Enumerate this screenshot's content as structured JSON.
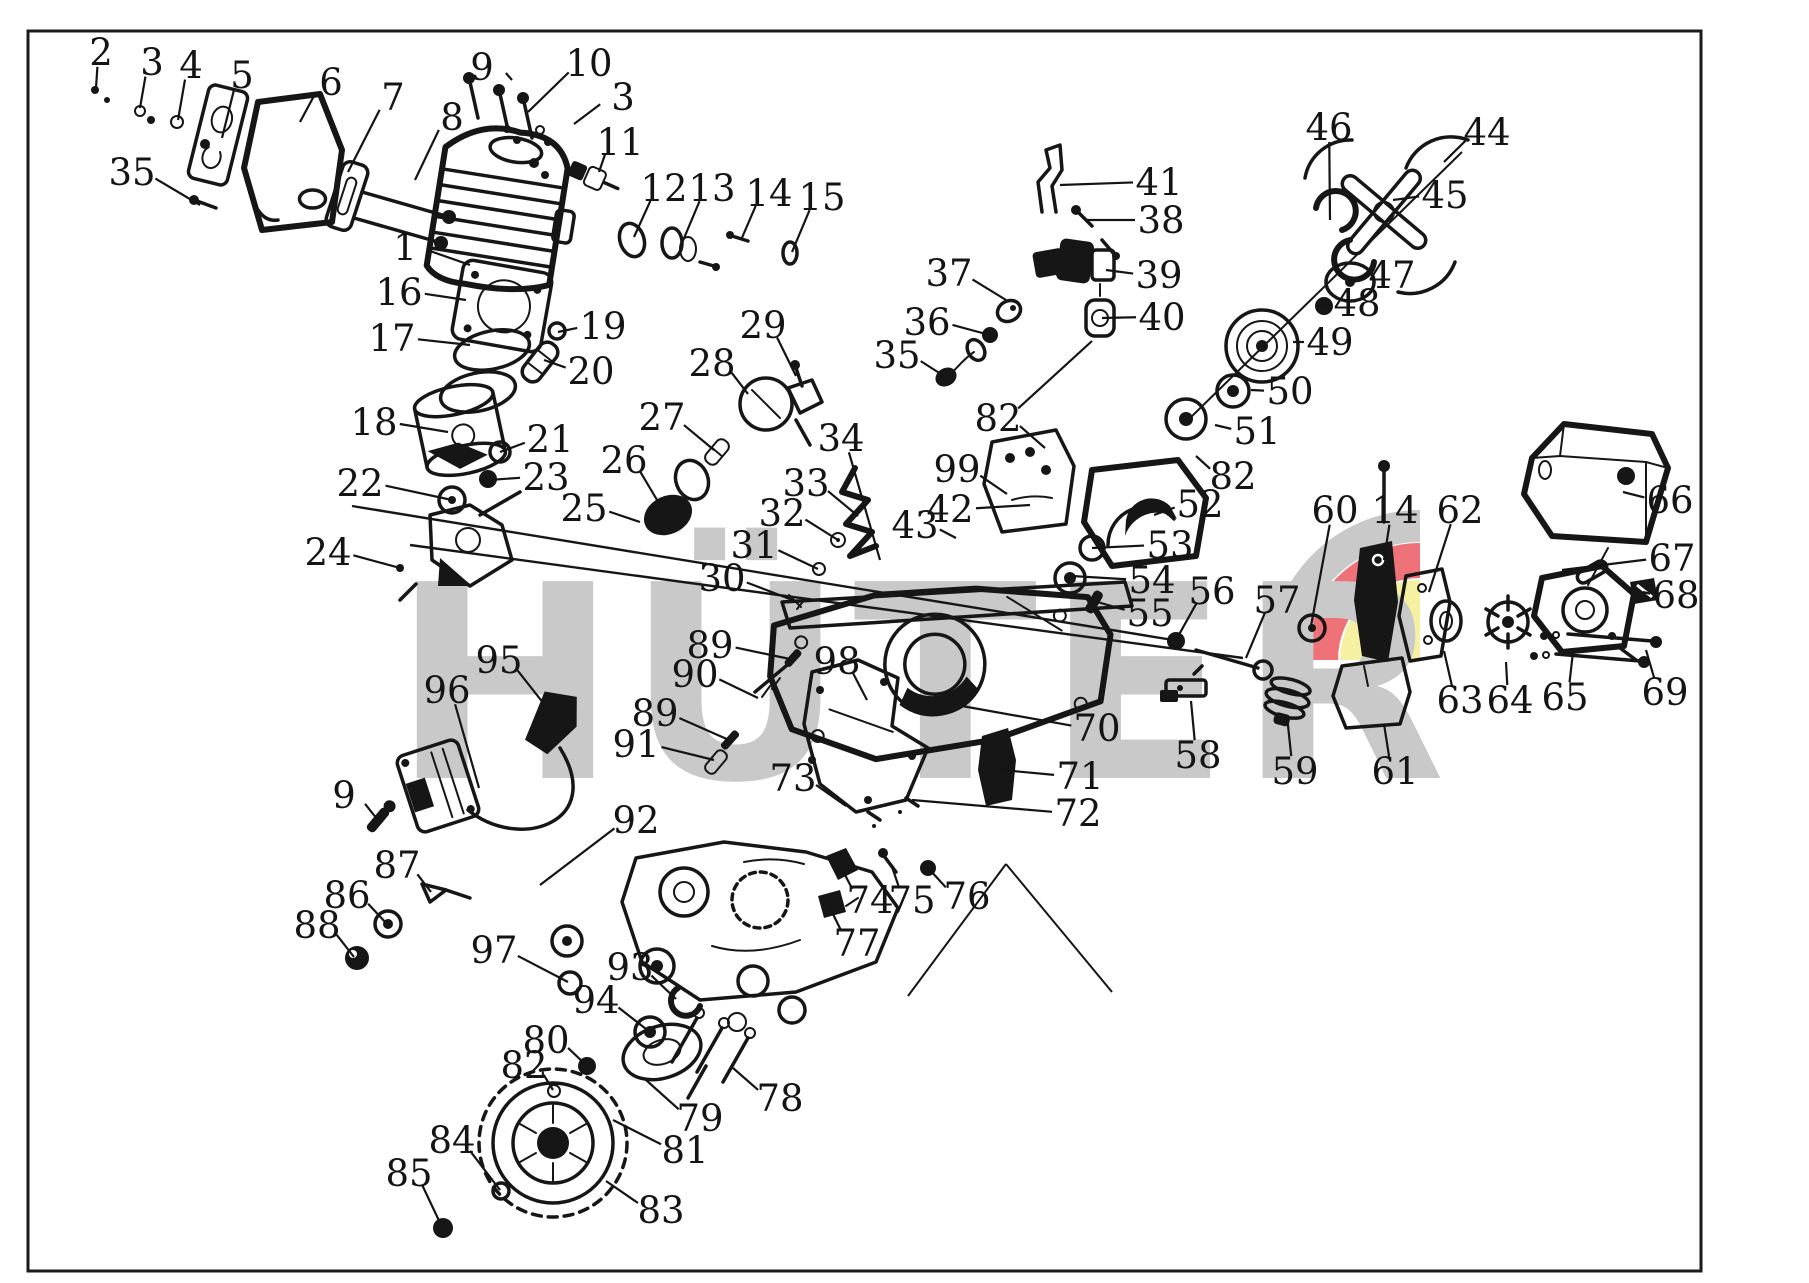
{
  "page": {
    "background": "#ffffff",
    "frame_color": "#1a1a1a"
  },
  "diagram": {
    "type": "exploded-parts-diagram",
    "subject": "chainsaw-engine-exploded-view",
    "watermark": {
      "text": "HÜTER",
      "color": "#c9c9c9"
    },
    "logo": {
      "gray": "#c9c9c9",
      "red": "#ee7278",
      "yellow": "#f6f0a3"
    },
    "line_color": "#161616",
    "labels": [
      {
        "n": "1",
        "x": 405,
        "y": 247,
        "leads": [
          [
            470,
            265
          ]
        ]
      },
      {
        "n": "2",
        "x": 101,
        "y": 52,
        "leads": [
          [
            96,
            88
          ]
        ]
      },
      {
        "n": "3",
        "x": 152,
        "y": 62,
        "leads": [
          [
            140,
            108
          ]
        ]
      },
      {
        "n": "3",
        "x": 623,
        "y": 97,
        "leads": [
          [
            574,
            124
          ]
        ]
      },
      {
        "n": "4",
        "x": 191,
        "y": 65,
        "leads": [
          [
            178,
            120
          ]
        ]
      },
      {
        "n": "5",
        "x": 242,
        "y": 75,
        "leads": [
          [
            222,
            138
          ]
        ]
      },
      {
        "n": "6",
        "x": 331,
        "y": 82,
        "leads": [
          [
            300,
            122
          ]
        ]
      },
      {
        "n": "7",
        "x": 393,
        "y": 97,
        "leads": [
          [
            348,
            172
          ]
        ]
      },
      {
        "n": "8",
        "x": 452,
        "y": 117,
        "leads": [
          [
            415,
            180
          ]
        ]
      },
      {
        "n": "9",
        "x": 482,
        "y": 67,
        "leads": [
          [
            512,
            80
          ]
        ]
      },
      {
        "n": "9",
        "x": 344,
        "y": 795,
        "leads": [
          [
            377,
            819
          ]
        ]
      },
      {
        "n": "10",
        "x": 589,
        "y": 63,
        "leads": [
          [
            528,
            112
          ]
        ]
      },
      {
        "n": "11",
        "x": 620,
        "y": 142,
        "leads": [
          [
            599,
            172
          ]
        ]
      },
      {
        "n": "12",
        "x": 664,
        "y": 188,
        "leads": [
          [
            634,
            237
          ]
        ]
      },
      {
        "n": "13",
        "x": 712,
        "y": 188,
        "leads": [
          [
            682,
            243
          ]
        ]
      },
      {
        "n": "14",
        "x": 769,
        "y": 193,
        "leads": [
          [
            741,
            240
          ]
        ]
      },
      {
        "n": "14",
        "x": 1395,
        "y": 510,
        "leads": [
          [
            1384,
            560
          ]
        ]
      },
      {
        "n": "15",
        "x": 822,
        "y": 197,
        "leads": [
          [
            792,
            252
          ]
        ]
      },
      {
        "n": "16",
        "x": 399,
        "y": 292,
        "leads": [
          [
            466,
            300
          ]
        ]
      },
      {
        "n": "17",
        "x": 392,
        "y": 338,
        "leads": [
          [
            470,
            345
          ]
        ]
      },
      {
        "n": "18",
        "x": 374,
        "y": 422,
        "leads": [
          [
            448,
            432
          ]
        ]
      },
      {
        "n": "19",
        "x": 603,
        "y": 326,
        "leads": [
          [
            558,
            332
          ]
        ]
      },
      {
        "n": "20",
        "x": 591,
        "y": 371,
        "leads": [
          [
            544,
            360
          ]
        ]
      },
      {
        "n": "21",
        "x": 550,
        "y": 439,
        "leads": [
          [
            500,
            452
          ]
        ]
      },
      {
        "n": "22",
        "x": 360,
        "y": 483,
        "leads": [
          [
            452,
            500
          ]
        ]
      },
      {
        "n": "23",
        "x": 546,
        "y": 477,
        "leads": [
          [
            489,
            480
          ]
        ]
      },
      {
        "n": "24",
        "x": 328,
        "y": 552,
        "leads": [
          [
            400,
            568
          ]
        ]
      },
      {
        "n": "25",
        "x": 584,
        "y": 508,
        "leads": [
          [
            640,
            522
          ]
        ]
      },
      {
        "n": "26",
        "x": 624,
        "y": 460,
        "leads": [
          [
            660,
            505
          ]
        ]
      },
      {
        "n": "27",
        "x": 662,
        "y": 417,
        "leads": [
          [
            714,
            450
          ]
        ]
      },
      {
        "n": "28",
        "x": 712,
        "y": 363,
        "leads": [
          [
            748,
            394
          ]
        ]
      },
      {
        "n": "29",
        "x": 763,
        "y": 325,
        "leads": [
          [
            796,
            376
          ]
        ]
      },
      {
        "n": "30",
        "x": 722,
        "y": 578,
        "leads": [
          [
            795,
            601
          ]
        ]
      },
      {
        "n": "31",
        "x": 754,
        "y": 545,
        "leads": [
          [
            818,
            569
          ]
        ]
      },
      {
        "n": "32",
        "x": 782,
        "y": 513,
        "leads": [
          [
            838,
            540
          ]
        ]
      },
      {
        "n": "33",
        "x": 806,
        "y": 483,
        "leads": [
          [
            858,
            516
          ]
        ]
      },
      {
        "n": "34",
        "x": 841,
        "y": 438,
        "leads": [
          [
            880,
            560
          ]
        ]
      },
      {
        "n": "35",
        "x": 132,
        "y": 172,
        "leads": [
          [
            200,
            205
          ]
        ]
      },
      {
        "n": "35",
        "x": 897,
        "y": 355,
        "leads": [
          [
            944,
            376
          ]
        ]
      },
      {
        "n": "36",
        "x": 927,
        "y": 322,
        "leads": [
          [
            986,
            334
          ]
        ]
      },
      {
        "n": "37",
        "x": 949,
        "y": 273,
        "leads": [
          [
            1006,
            300
          ]
        ]
      },
      {
        "n": "38",
        "x": 1161,
        "y": 220,
        "leads": [
          [
            1086,
            220
          ]
        ]
      },
      {
        "n": "39",
        "x": 1159,
        "y": 275,
        "leads": [
          [
            1106,
            270
          ]
        ]
      },
      {
        "n": "40",
        "x": 1162,
        "y": 317,
        "leads": [
          [
            1102,
            318
          ]
        ]
      },
      {
        "n": "41",
        "x": 1159,
        "y": 182,
        "leads": [
          [
            1060,
            185
          ]
        ]
      },
      {
        "n": "42",
        "x": 950,
        "y": 509,
        "leads": [
          [
            1030,
            505
          ]
        ]
      },
      {
        "n": "43",
        "x": 915,
        "y": 525,
        "leads": [
          [
            956,
            538
          ]
        ]
      },
      {
        "n": "44",
        "x": 1487,
        "y": 132,
        "leads": [
          [
            1444,
            162
          ]
        ]
      },
      {
        "n": "45",
        "x": 1445,
        "y": 195,
        "leads": [
          [
            1393,
            200
          ]
        ]
      },
      {
        "n": "46",
        "x": 1329,
        "y": 127,
        "leads": [
          [
            1330,
            220
          ]
        ]
      },
      {
        "n": "47",
        "x": 1392,
        "y": 275,
        "leads": [
          [
            1349,
            281
          ]
        ]
      },
      {
        "n": "48",
        "x": 1357,
        "y": 303,
        "leads": [
          [
            1323,
            305
          ]
        ]
      },
      {
        "n": "49",
        "x": 1330,
        "y": 342,
        "leads": [
          [
            1293,
            342
          ]
        ]
      },
      {
        "n": "50",
        "x": 1290,
        "y": 391,
        "leads": [
          [
            1251,
            390
          ]
        ]
      },
      {
        "n": "51",
        "x": 1257,
        "y": 431,
        "leads": [
          [
            1215,
            425
          ]
        ]
      },
      {
        "n": "52",
        "x": 1200,
        "y": 504,
        "leads": [
          [
            1154,
            515
          ]
        ]
      },
      {
        "n": "53",
        "x": 1170,
        "y": 545,
        "leads": [
          [
            1092,
            548
          ]
        ]
      },
      {
        "n": "54",
        "x": 1152,
        "y": 580,
        "leads": [
          [
            1072,
            576
          ]
        ]
      },
      {
        "n": "55",
        "x": 1150,
        "y": 613,
        "leads": [
          [
            1094,
            601
          ]
        ]
      },
      {
        "n": "56",
        "x": 1212,
        "y": 591,
        "leads": [
          [
            1176,
            640
          ]
        ]
      },
      {
        "n": "57",
        "x": 1277,
        "y": 600,
        "leads": [
          [
            1246,
            658
          ]
        ]
      },
      {
        "n": "58",
        "x": 1198,
        "y": 755,
        "leads": [
          [
            1191,
            701
          ]
        ]
      },
      {
        "n": "59",
        "x": 1295,
        "y": 771,
        "leads": [
          [
            1287,
            716
          ]
        ]
      },
      {
        "n": "60",
        "x": 1335,
        "y": 510,
        "leads": [
          [
            1311,
            626
          ]
        ]
      },
      {
        "n": "61",
        "x": 1395,
        "y": 771,
        "leads": [
          [
            1384,
            724
          ]
        ]
      },
      {
        "n": "62",
        "x": 1460,
        "y": 510,
        "leads": [
          [
            1429,
            592
          ]
        ]
      },
      {
        "n": "63",
        "x": 1460,
        "y": 700,
        "leads": [
          [
            1444,
            651
          ]
        ]
      },
      {
        "n": "64",
        "x": 1510,
        "y": 700,
        "leads": [
          [
            1506,
            662
          ]
        ]
      },
      {
        "n": "65",
        "x": 1565,
        "y": 697,
        "leads": [
          [
            1573,
            652
          ]
        ]
      },
      {
        "n": "66",
        "x": 1670,
        "y": 500,
        "leads": [
          [
            1623,
            492
          ]
        ]
      },
      {
        "n": "67",
        "x": 1672,
        "y": 558,
        "leads": [
          [
            1562,
            570
          ]
        ]
      },
      {
        "n": "68",
        "x": 1676,
        "y": 595,
        "leads": [
          [
            1643,
            592
          ]
        ]
      },
      {
        "n": "69",
        "x": 1665,
        "y": 692,
        "leads": [
          [
            1646,
            650
          ]
        ]
      },
      {
        "n": "70",
        "x": 1097,
        "y": 728,
        "leads": [
          [
            962,
            706
          ]
        ]
      },
      {
        "n": "71",
        "x": 1080,
        "y": 776,
        "leads": [
          [
            1002,
            770
          ]
        ]
      },
      {
        "n": "72",
        "x": 1078,
        "y": 813,
        "leads": [
          [
            912,
            800
          ]
        ]
      },
      {
        "n": "73",
        "x": 793,
        "y": 778,
        "leads": [
          [
            846,
            806
          ]
        ]
      },
      {
        "n": "74",
        "x": 870,
        "y": 900,
        "leads": [
          [
            843,
            871
          ]
        ]
      },
      {
        "n": "75",
        "x": 912,
        "y": 900,
        "leads": [
          [
            891,
            864
          ]
        ]
      },
      {
        "n": "76",
        "x": 967,
        "y": 896,
        "leads": [
          [
            929,
            869
          ]
        ]
      },
      {
        "n": "77",
        "x": 857,
        "y": 943,
        "leads": [
          [
            829,
            906
          ]
        ]
      },
      {
        "n": "78",
        "x": 780,
        "y": 1098,
        "leads": [
          [
            733,
            1068
          ]
        ]
      },
      {
        "n": "79",
        "x": 700,
        "y": 1118,
        "leads": [
          [
            646,
            1080
          ]
        ]
      },
      {
        "n": "80",
        "x": 546,
        "y": 1040,
        "leads": [
          [
            586,
            1065
          ]
        ]
      },
      {
        "n": "81",
        "x": 685,
        "y": 1150,
        "leads": [
          [
            613,
            1120
          ]
        ]
      },
      {
        "n": "82",
        "x": 998,
        "y": 418,
        "leads": [
          [
            1045,
            448
          ],
          [
            1092,
            341
          ]
        ]
      },
      {
        "n": "82",
        "x": 1233,
        "y": 476,
        "leads": [
          [
            1196,
            456
          ]
        ]
      },
      {
        "n": "82",
        "x": 524,
        "y": 1065,
        "leads": [
          [
            553,
            1090
          ]
        ]
      },
      {
        "n": "83",
        "x": 661,
        "y": 1210,
        "leads": [
          [
            606,
            1181
          ]
        ]
      },
      {
        "n": "84",
        "x": 452,
        "y": 1140,
        "leads": [
          [
            500,
            1190
          ]
        ]
      },
      {
        "n": "85",
        "x": 409,
        "y": 1173,
        "leads": [
          [
            442,
            1227
          ]
        ]
      },
      {
        "n": "86",
        "x": 347,
        "y": 895,
        "leads": [
          [
            386,
            923
          ]
        ]
      },
      {
        "n": "87",
        "x": 397,
        "y": 865,
        "leads": [
          [
            431,
            892
          ]
        ]
      },
      {
        "n": "88",
        "x": 317,
        "y": 925,
        "leads": [
          [
            354,
            957
          ]
        ]
      },
      {
        "n": "89",
        "x": 710,
        "y": 645,
        "leads": [
          [
            790,
            659
          ]
        ]
      },
      {
        "n": "89",
        "x": 655,
        "y": 713,
        "leads": [
          [
            729,
            740
          ]
        ]
      },
      {
        "n": "90",
        "x": 695,
        "y": 674,
        "leads": [
          [
            758,
            698
          ]
        ]
      },
      {
        "n": "91",
        "x": 636,
        "y": 744,
        "leads": [
          [
            714,
            760
          ]
        ]
      },
      {
        "n": "92",
        "x": 636,
        "y": 820,
        "leads": [
          [
            540,
            885
          ]
        ]
      },
      {
        "n": "93",
        "x": 630,
        "y": 967,
        "leads": [
          [
            676,
            999
          ]
        ]
      },
      {
        "n": "94",
        "x": 596,
        "y": 1000,
        "leads": [
          [
            646,
            1029
          ]
        ]
      },
      {
        "n": "95",
        "x": 499,
        "y": 660,
        "leads": [
          [
            544,
            704
          ]
        ]
      },
      {
        "n": "96",
        "x": 447,
        "y": 690,
        "leads": [
          [
            479,
            788
          ]
        ]
      },
      {
        "n": "97",
        "x": 494,
        "y": 950,
        "leads": [
          [
            568,
            982
          ]
        ]
      },
      {
        "n": "98",
        "x": 837,
        "y": 661,
        "leads": [
          [
            867,
            700
          ]
        ]
      },
      {
        "n": "99",
        "x": 957,
        "y": 469,
        "leads": [
          [
            1007,
            494
          ]
        ]
      }
    ]
  }
}
